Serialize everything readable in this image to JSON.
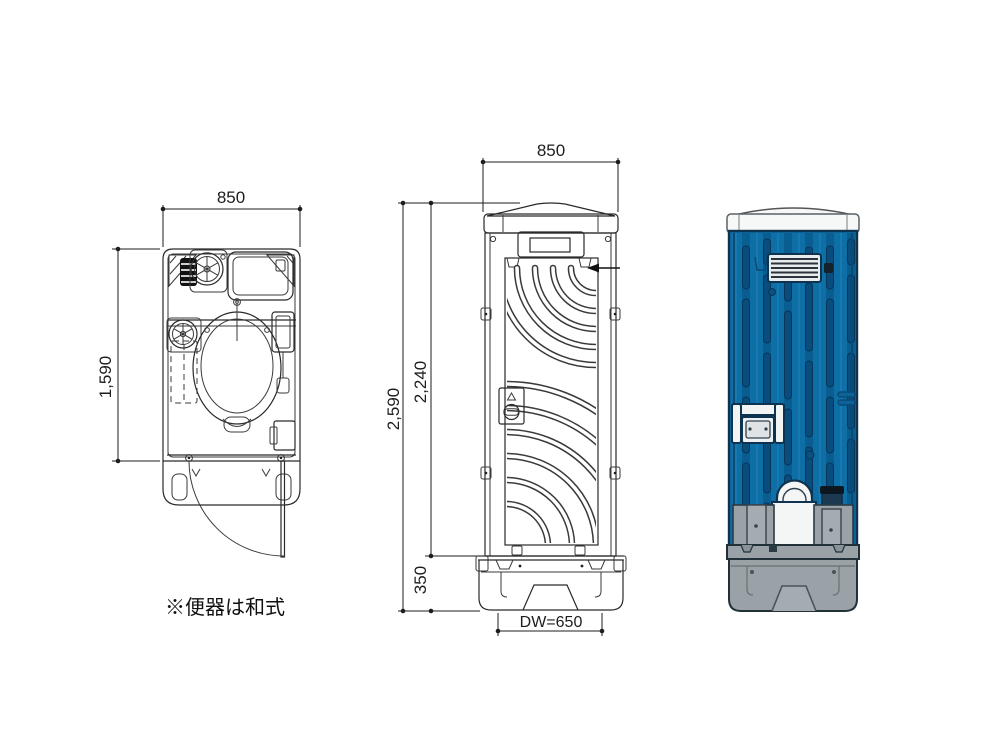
{
  "labels": {
    "plan_width": "850",
    "plan_depth": "1,590",
    "elev_width": "850",
    "total_height": "2,590",
    "body_height": "2,240",
    "base_height": "350",
    "door_width": "DW=650",
    "note": "※便器は和式"
  },
  "colors": {
    "line": "#2a2a2a",
    "body_blue": "#0e6fa6",
    "groove_blue": "#0a5d90",
    "capsule_blue": "#094d7e",
    "outline_navy": "#0d3350",
    "base_gray": "#9aa2a7",
    "pillar_gray": "#a4acb1",
    "roof_white": "#f6f7f7",
    "louver_white": "#e9ecee",
    "slat_dark": "#2b343c"
  }
}
